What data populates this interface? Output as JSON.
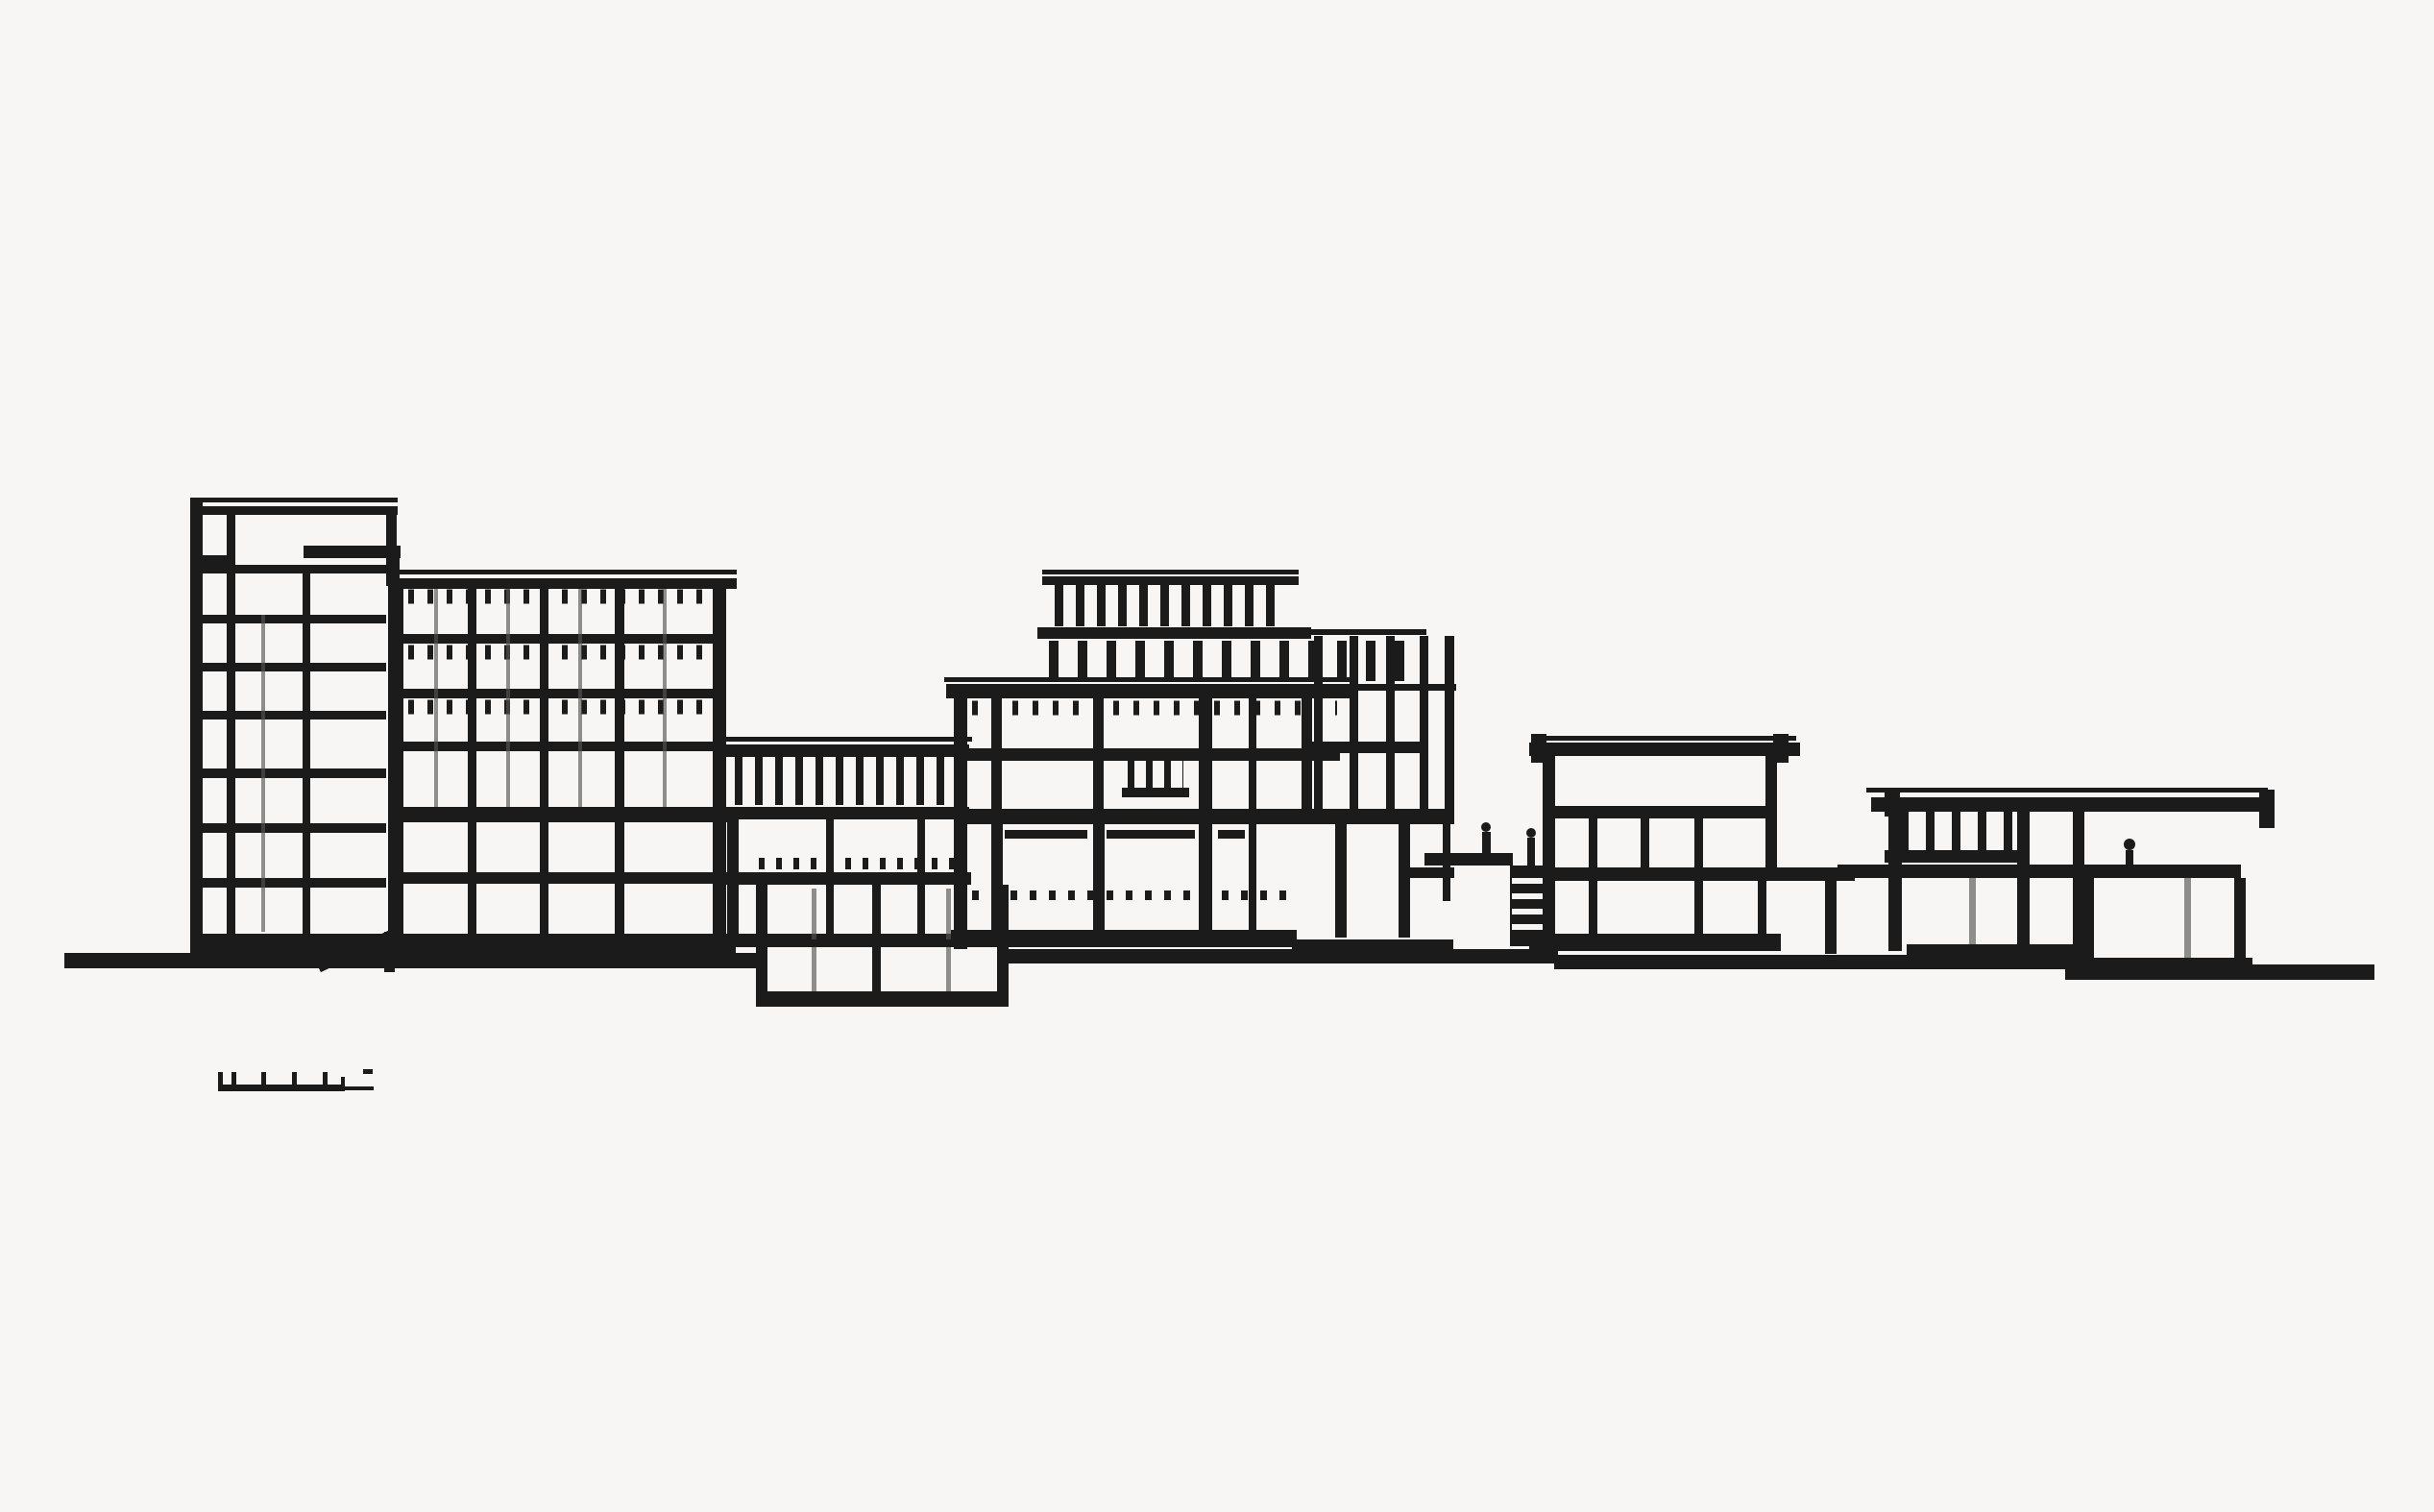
{
  "document": {
    "kind": "architectural-section-drawing",
    "medium": "black ink line drawing on paper",
    "orientation": "landscape"
  },
  "palette": {
    "paper": "#f7f6f4",
    "ink": "#1b1b1b",
    "ink_light": "#555555"
  },
  "drawing": {
    "blocks": [
      {
        "id": "tall-slab-block"
      },
      {
        "id": "grid-block"
      },
      {
        "id": "clerestory-hall"
      },
      {
        "id": "basement"
      },
      {
        "id": "central-block"
      },
      {
        "id": "roof-penthouse"
      },
      {
        "id": "glazed-tower"
      },
      {
        "id": "service-structures"
      },
      {
        "id": "two-story-pavilion"
      },
      {
        "id": "walkway"
      },
      {
        "id": "right-pavilion"
      },
      {
        "id": "ground-line"
      },
      {
        "id": "ramp"
      },
      {
        "id": "scale-bar"
      }
    ],
    "scale_bar": {
      "tick_count": 5
    }
  }
}
